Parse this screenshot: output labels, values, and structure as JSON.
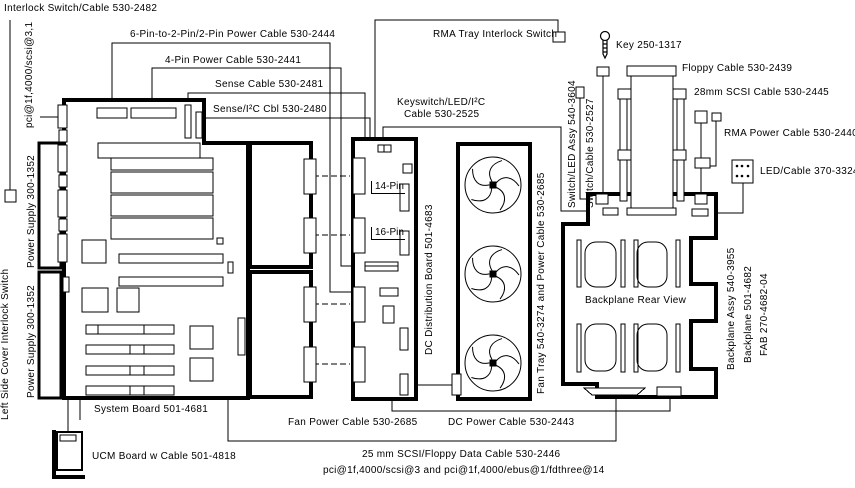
{
  "diagram": {
    "title": "Server cabling diagram",
    "colors": {
      "line": "#000000",
      "background": "#ffffff"
    },
    "labels": {
      "interlock_cable": "Interlock Switch/Cable 530-2482",
      "six_pin": "6-Pin-to-2-Pin/2-Pin Power Cable 530-2444",
      "four_pin": "4-Pin Power Cable 530-2441",
      "sense": "Sense Cable 530-2481",
      "sense_i2c": "Sense/I²C Cbl 530-2480",
      "rma_interlock": "RMA Tray Interlock Switch",
      "key": "Key 250-1317",
      "keyswitch_line1": "Keyswitch/LED/I²C",
      "keyswitch_line2": "Cable 530-2525",
      "floppy": "Floppy Cable 530-2439",
      "scsi28": "28mm SCSI Cable 530-2445",
      "rma_power": "RMA Power Cable 530-2440",
      "led_cable": "LED/Cable 370-3324",
      "backplane_rear": "Backplane Rear View",
      "system_board": "System Board 501-4681",
      "ucm": "UCM Board w Cable 501-4818",
      "fan_power": "Fan Power Cable 530-2685",
      "dc_power": "DC Power Cable 530-2443",
      "scsi_floppy": "25 mm SCSI/Floppy Data Cable 530-2446",
      "pci_bottom": "pci@1f,4000/scsi@3 and pci@1f,4000/ebus@1/fdthree@14",
      "pin14": "14-Pin",
      "pin16": "16-Pin",
      "pci_scsi31": "pci@1f,4000/scsi@3,1",
      "power_supply_1": "Power Supply 300-1352",
      "power_supply_2": "Power Supply 300-1352",
      "left_cover": "Left Side Cover Interlock Switch",
      "dc_dist": "DC Distribution Board 501-4683",
      "fan_tray": "Fan Tray 540-3274 and Power Cable 530-2685",
      "switch_led": "Switch/LED Assy 540-3604",
      "switch_cable": "Switch/Cable 530-2527",
      "backplane_assy": "Backplane Assy 540-3955",
      "backplane_num": "Backplane 501-4682",
      "fab": "FAB 270-4682-04"
    }
  }
}
